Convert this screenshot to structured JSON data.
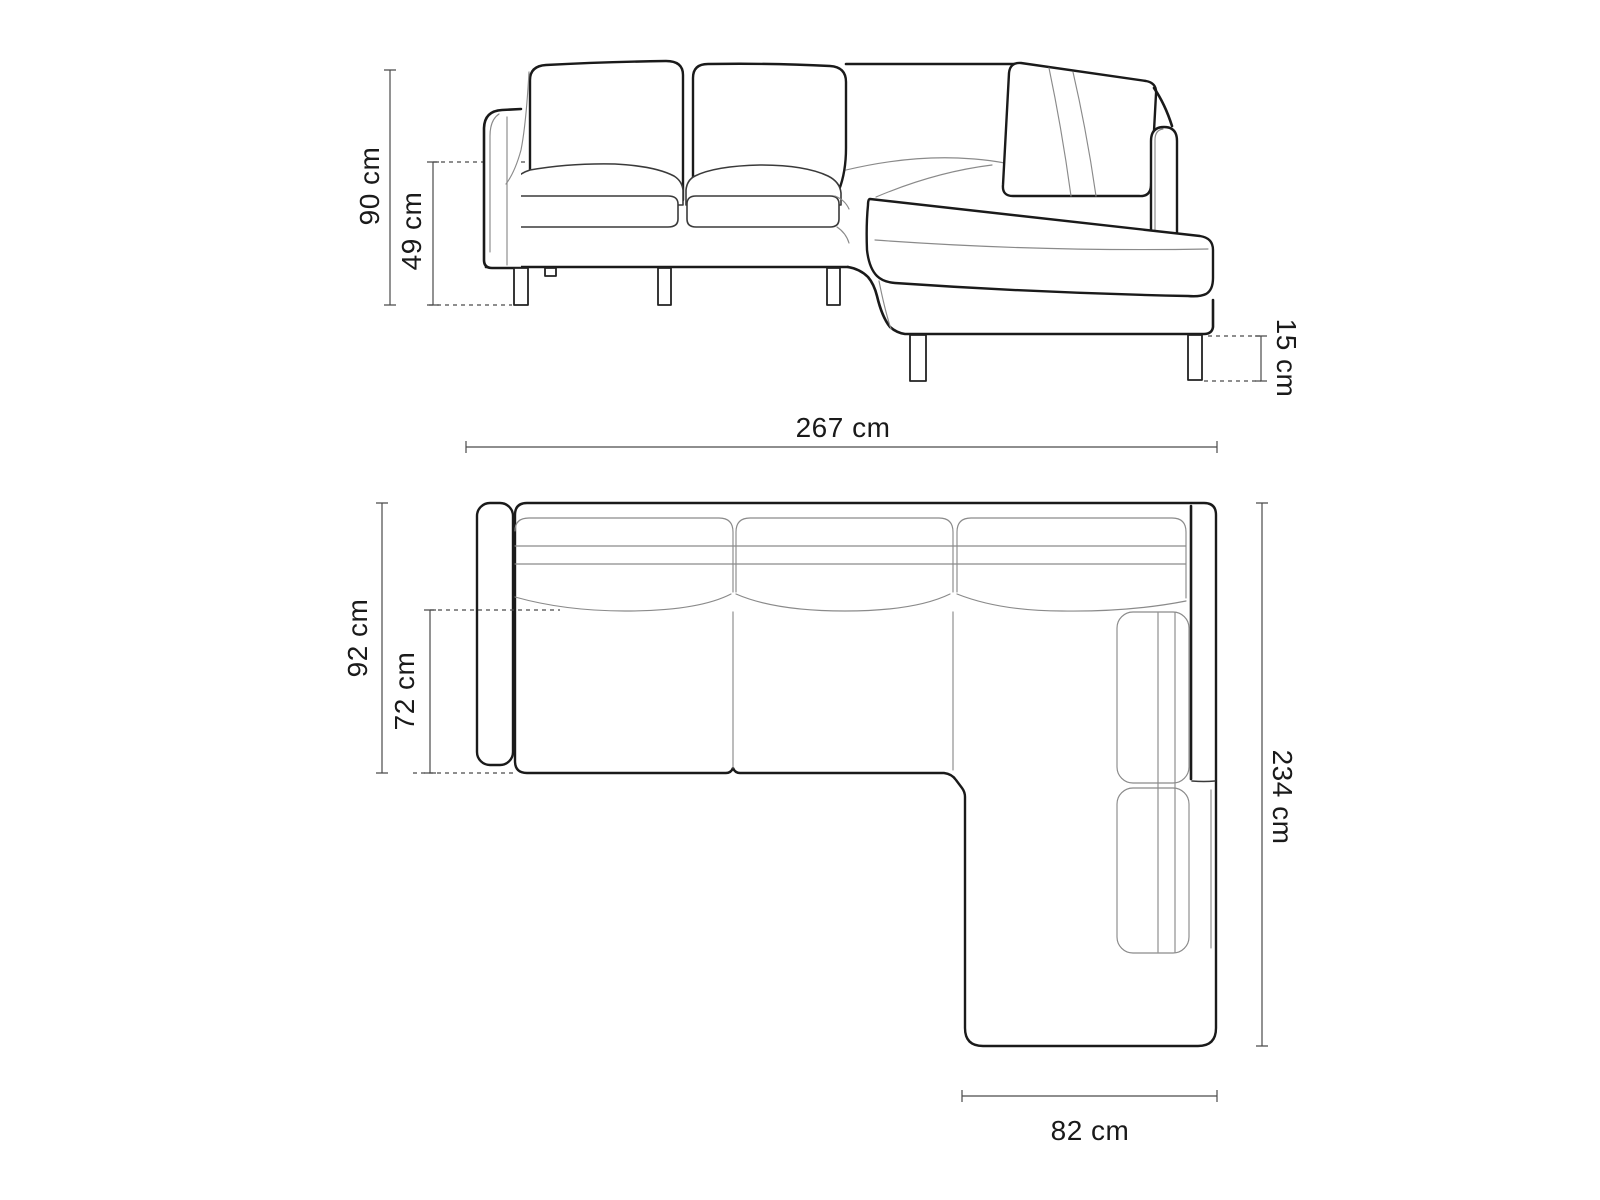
{
  "page": {
    "background": "#ffffff"
  },
  "diagram": {
    "subject": "corner-sofa-technical-dimension-drawing",
    "views": [
      {
        "id": "front-elevation",
        "dimensions": [
          {
            "id": "overall-height",
            "label": "90 cm"
          },
          {
            "id": "seat-height",
            "label": "49 cm"
          },
          {
            "id": "leg-height",
            "label": "15 cm"
          }
        ]
      },
      {
        "id": "top-plan",
        "dimensions": [
          {
            "id": "overall-width",
            "label": "267 cm"
          },
          {
            "id": "overall-depth",
            "label": "92 cm"
          },
          {
            "id": "seat-depth",
            "label": "72 cm"
          },
          {
            "id": "right-side-length",
            "label": "234 cm"
          },
          {
            "id": "chaise-width",
            "label": "82 cm"
          }
        ]
      }
    ],
    "colors": {
      "outline": "#1a1a1a",
      "medium": "#3a3a3a",
      "detail": "#8a8a8a",
      "dimension": "#4a4a4a",
      "background": "#ffffff"
    }
  }
}
